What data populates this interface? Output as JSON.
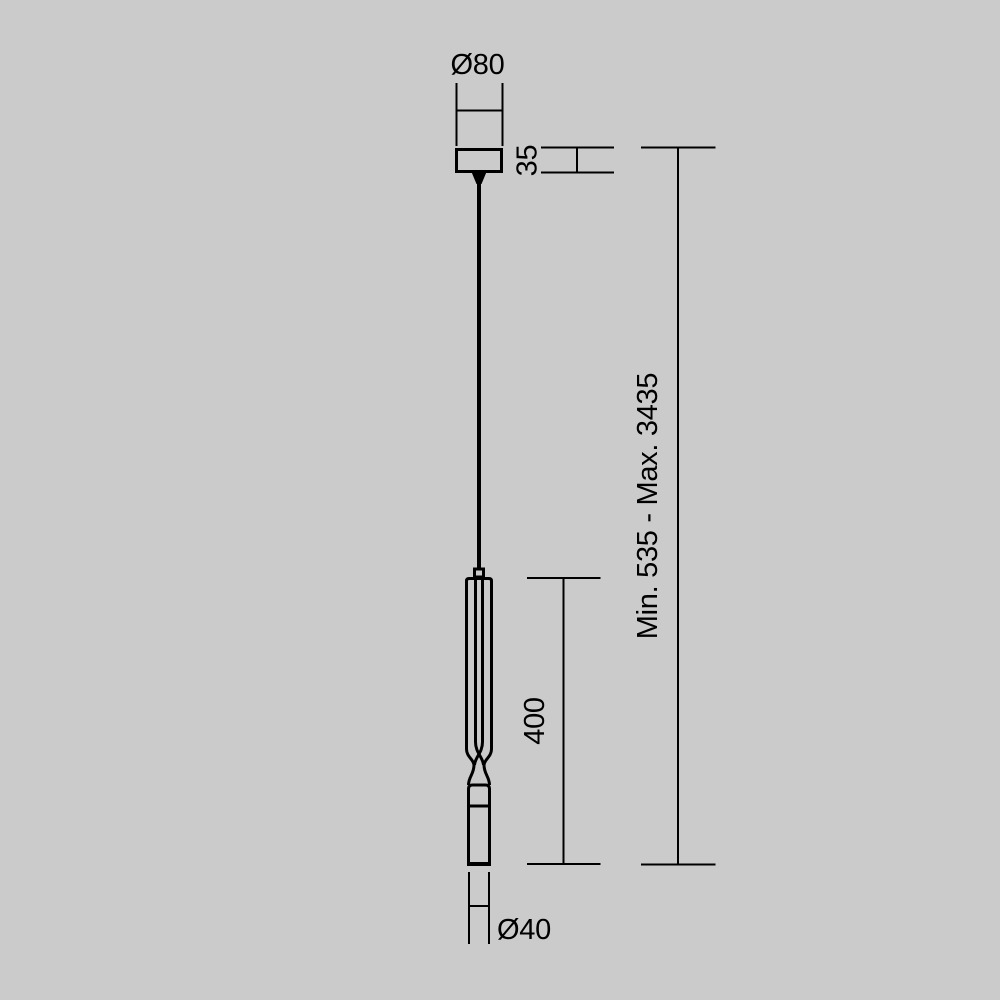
{
  "drawing": {
    "colors": {
      "background": "#cbcbcb",
      "line": "#000000"
    },
    "labels": {
      "canopy_diameter": "Ø80",
      "canopy_height": "35",
      "body_length": "400",
      "suspension_range": "Min. 535 - Max. 3435",
      "tip_diameter": "Ø40"
    },
    "values": {
      "canopy_diameter_mm": 80,
      "canopy_height_mm": 35,
      "body_length_mm": 400,
      "suspension_min_mm": 535,
      "suspension_max_mm": 3435,
      "tip_diameter_mm": 40
    }
  }
}
